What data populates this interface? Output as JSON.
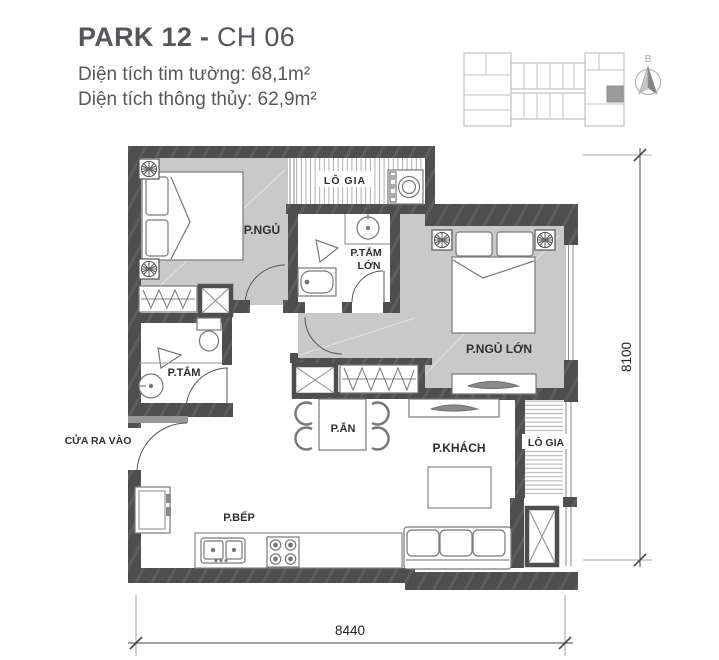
{
  "header": {
    "title_primary": "PARK 12 -",
    "title_secondary": " CH 06",
    "area_line1": "Diện tích tim tường: 68,1m²",
    "area_line2": "Diện tích thông thủy: 62,9m²"
  },
  "locator": {
    "north_label": "B"
  },
  "plan": {
    "rooms": {
      "bedroom": "P.NGỦ",
      "loggia_top": "LÔ GIA",
      "big_bath_line1": "P.TẮM",
      "big_bath_line2": "LỚN",
      "master_bedroom": "P.NGỦ LỚN",
      "bathroom": "P.TẮM",
      "dining": "P.ĂN",
      "living": "P.KHÁCH",
      "loggia_side": "LÔ GIA",
      "kitchen": "P.BẾP",
      "entrance": "CỬA RA VÀO"
    },
    "dimensions": {
      "horizontal": "8440",
      "vertical": "8100"
    }
  },
  "colors": {
    "wall": "#4e4e4e",
    "floor": "#c9c9c9",
    "highlight_unit": "#9c9c9c",
    "furniture_line": "#777777",
    "title_text": "#55565a"
  }
}
